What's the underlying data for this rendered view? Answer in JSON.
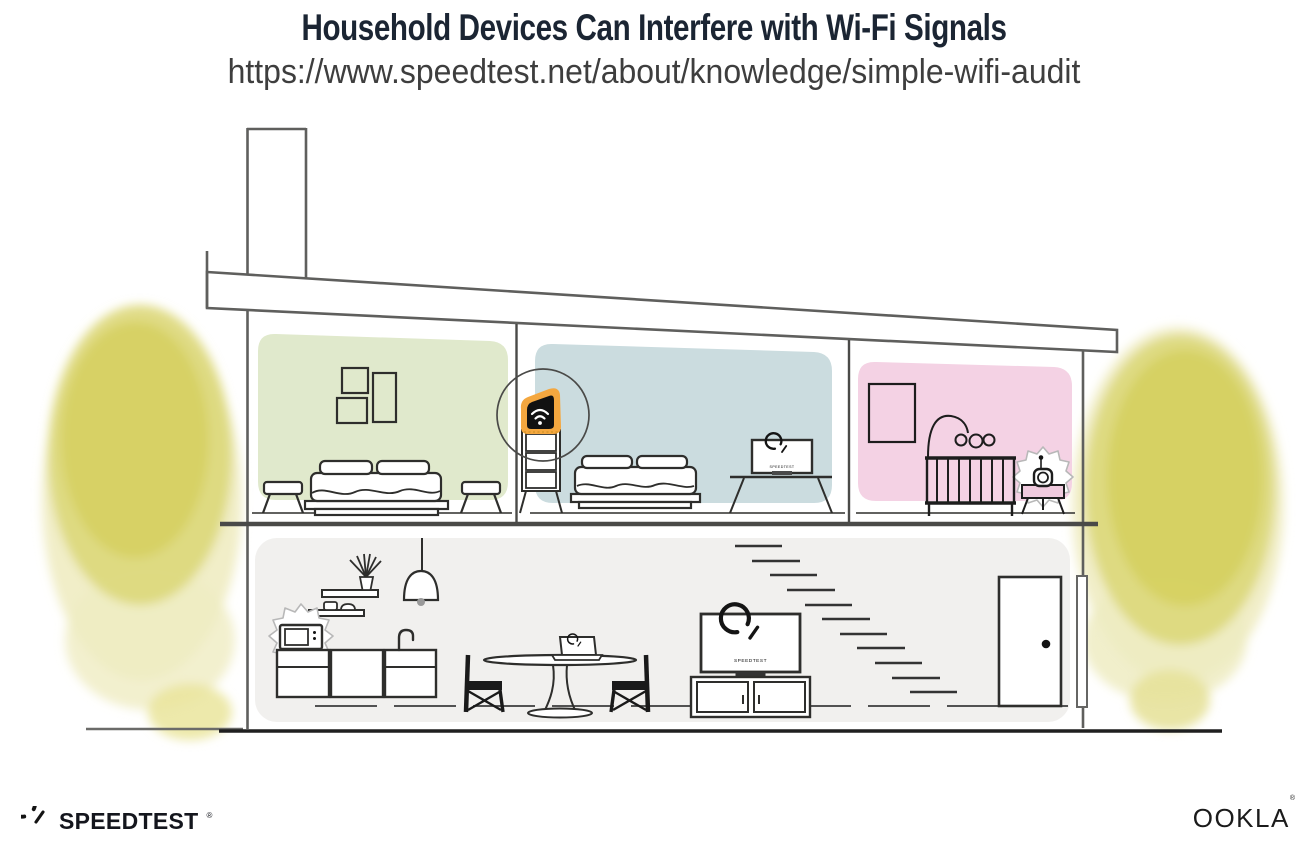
{
  "header": {
    "title": "Household Devices Can Interfere with Wi-Fi Signals",
    "url": "https://www.speedtest.net/about/knowledge/simple-wifi-audit"
  },
  "screens": {
    "upstairs_tv_label": "SPEEDTEST",
    "downstairs_tv_label": "SPEEDTEST"
  },
  "footer": {
    "speedtest_logo_text": "SPEEDTEST",
    "speedtest_reg_mark": "®",
    "ookla_logo_text": "OOKLA",
    "ookla_reg_mark": "®"
  },
  "scene": {
    "description": "Cross-section illustration of a two-story house",
    "upper_rooms": [
      {
        "name": "bedroom-green",
        "items": [
          "wall-frames",
          "bed",
          "two-stools"
        ]
      },
      {
        "name": "bedroom-blue",
        "items": [
          "wifi-router-on-dresser",
          "highlight-circle",
          "bed",
          "tv-with-speedtest"
        ]
      },
      {
        "name": "nursery-pink",
        "items": [
          "wall-frame",
          "crib-with-mobile",
          "baby-monitor-on-side-table"
        ]
      }
    ],
    "lower_rooms": [
      {
        "name": "kitchen-living",
        "items": [
          "wall-shelves",
          "plant",
          "pendant-lamp",
          "microwave",
          "kitchen-cabinets",
          "sink-faucet",
          "dining-table",
          "laptop-with-speedtest",
          "two-chairs",
          "tv-with-speedtest",
          "media-console",
          "stairs",
          "door",
          "downspout"
        ]
      }
    ],
    "highlighted_device": "wifi-router",
    "interference_sources": [
      "microwave",
      "baby-monitor"
    ],
    "stairs_step_count": 11
  },
  "colors": {
    "title_text": "#1b2533",
    "url_text": "#3e3e3e",
    "outline_dark": "#2e2e2c",
    "structure_gray": "#5f5f5d",
    "wall_green": "#e0e9cc",
    "wall_blue": "#cbdcdf",
    "wall_pink": "#f4d2e4",
    "wall_downstairs": "#f1f0ee",
    "router_orange": "#f4a73f",
    "watercolor_yellow": "#ddd87a",
    "watercolor_yellow_dense": "#d5cf5c",
    "watercolor_yellow_light": "#efecc2",
    "logo_dark": "#14161d"
  }
}
